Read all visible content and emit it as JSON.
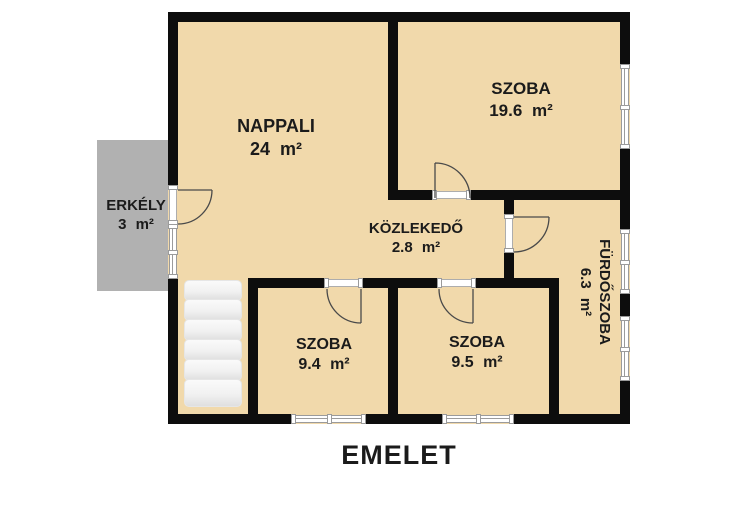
{
  "title": {
    "label": "EMELET"
  },
  "rooms": [
    {
      "key": "nappali",
      "name": "NAPPALI",
      "area": "24 m²"
    },
    {
      "key": "szoba-felso",
      "name": "SZOBA",
      "area": "19.6 m²"
    },
    {
      "key": "kozlekedo",
      "name": "KÖZLEKEDŐ",
      "area": "2.8 m²"
    },
    {
      "key": "erkely",
      "name": "ERKÉLY",
      "area": "3 m²"
    },
    {
      "key": "furdoszoba",
      "name": "FÜRDŐSZOBA",
      "area": "6.3 m²"
    },
    {
      "key": "szoba-bal",
      "name": "SZOBA",
      "area": "9.4 m²"
    },
    {
      "key": "szoba-jobb",
      "name": "SZOBA",
      "area": "9.5 m²"
    }
  ],
  "colors": {
    "floor": "#f1d9ab",
    "wall": "#0d0d0d",
    "balcony": "#b1b1b1",
    "window_frame": "#9b9b9b",
    "stairs": "#f2f2f2",
    "text": "#1b1b1b"
  }
}
